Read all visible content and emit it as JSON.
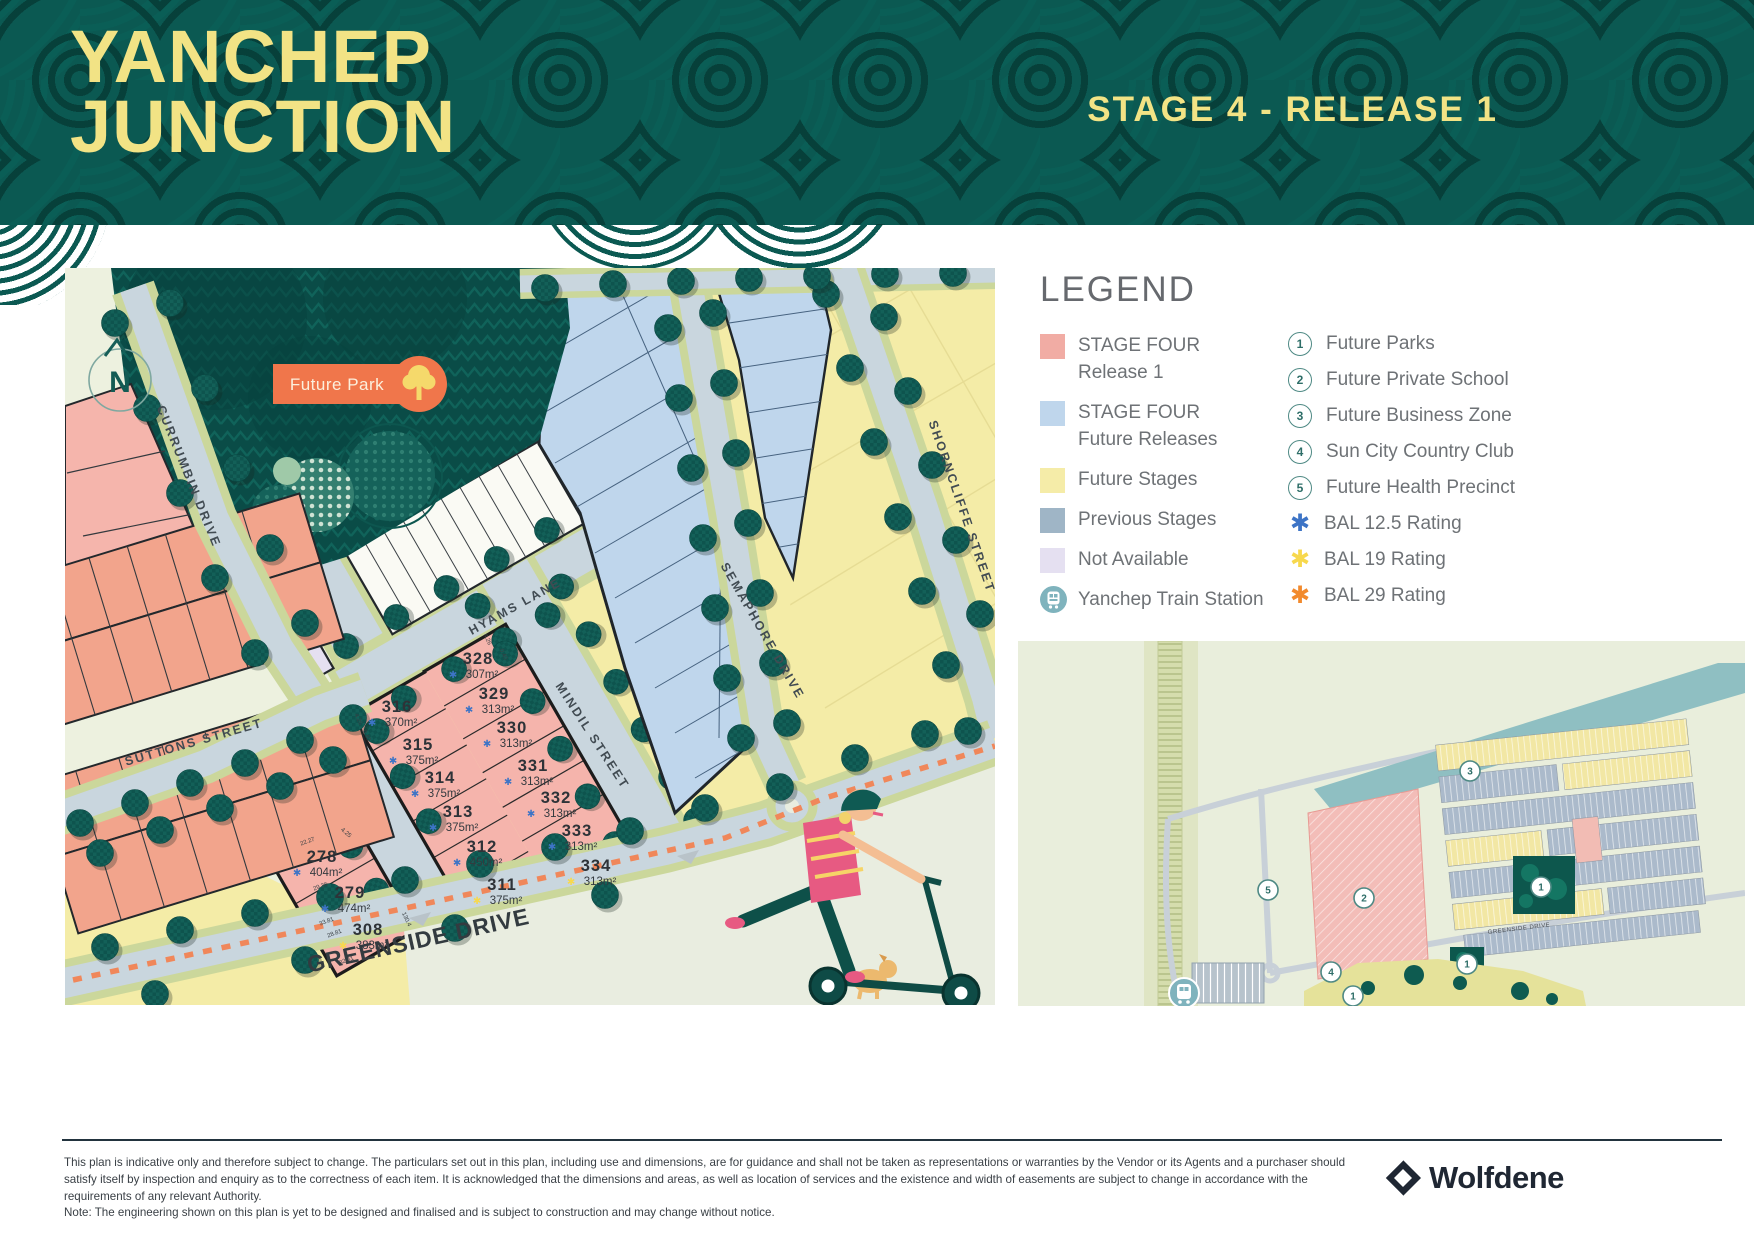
{
  "header": {
    "brand1": "YANCHEP",
    "brand2": "JUNCTION",
    "stage": "STAGE 4 - RELEASE 1"
  },
  "map": {
    "future_park": "Future Park",
    "north": "N",
    "bal_colors": {
      "12.5": "#3D74C6",
      "19": "#F7D84D",
      "29": "#F28A2D"
    },
    "streets": [
      {
        "label": "CURRUMBIN DRIVE",
        "x": 120,
        "y": 210,
        "r": 68
      },
      {
        "label": "SUTTONS STREET",
        "x": 130,
        "y": 478,
        "r": -16
      },
      {
        "label": "HYAMS LANE",
        "x": 452,
        "y": 342,
        "r": -29
      },
      {
        "label": "MINDIL STREET",
        "x": 524,
        "y": 470,
        "r": 57
      },
      {
        "label": "SEMAPHORE DRIVE",
        "x": 694,
        "y": 365,
        "r": 60
      },
      {
        "label": "SHORNCLIFFE STREET",
        "x": 893,
        "y": 240,
        "r": 71
      },
      {
        "label": "GREENSIDE DRIVE",
        "x": 355,
        "y": 680,
        "r": -12.5,
        "big": true
      }
    ],
    "lots": [
      {
        "num": "316",
        "area": "370m²",
        "bal": "12.5",
        "x": 332,
        "y": 444
      },
      {
        "num": "315",
        "area": "375m²",
        "bal": "12.5",
        "x": 353,
        "y": 482
      },
      {
        "num": "314",
        "area": "375m²",
        "bal": "12.5",
        "x": 375,
        "y": 515
      },
      {
        "num": "313",
        "area": "375m²",
        "bal": "12.5",
        "x": 393,
        "y": 549
      },
      {
        "num": "312",
        "area": "450m²",
        "bal": "12.5",
        "x": 417,
        "y": 584
      },
      {
        "num": "311",
        "area": "375m²",
        "bal": "19",
        "x": 437,
        "y": 622
      },
      {
        "num": "328",
        "area": "307m²",
        "bal": "12.5",
        "x": 413,
        "y": 396
      },
      {
        "num": "329",
        "area": "313m²",
        "bal": "12.5",
        "x": 429,
        "y": 431
      },
      {
        "num": "330",
        "area": "313m²",
        "bal": "12.5",
        "x": 447,
        "y": 465
      },
      {
        "num": "331",
        "area": "313m²",
        "bal": "12.5",
        "x": 468,
        "y": 503
      },
      {
        "num": "332",
        "area": "313m²",
        "bal": "12.5",
        "x": 491,
        "y": 535
      },
      {
        "num": "333",
        "area": "313m²",
        "bal": "12.5",
        "x": 512,
        "y": 568
      },
      {
        "num": "334",
        "area": "313m²",
        "bal": "19",
        "x": 531,
        "y": 603
      },
      {
        "num": "278",
        "area": "404m²",
        "bal": "12.5",
        "x": 257,
        "y": 594
      },
      {
        "num": "279",
        "area": "474m²",
        "bal": "12.5",
        "x": 285,
        "y": 630
      },
      {
        "num": "308",
        "area": "383m²",
        "bal": "19",
        "x": 303,
        "y": 667
      }
    ],
    "dims": [
      {
        "t": "22.27",
        "x": 243,
        "y": 575,
        "r": -20
      },
      {
        "t": "29.36",
        "x": 256,
        "y": 620,
        "r": -20
      },
      {
        "t": "33.81",
        "x": 262,
        "y": 655,
        "r": -20
      },
      {
        "t": "28.81",
        "x": 270,
        "y": 667,
        "r": -20
      },
      {
        "t": "32.51",
        "x": 282,
        "y": 694,
        "r": -20
      },
      {
        "t": "4.25",
        "x": 280,
        "y": 566,
        "r": 40
      },
      {
        "t": "4.26",
        "x": 292,
        "y": 452,
        "r": 65
      },
      {
        "t": "0.40",
        "x": 300,
        "y": 468,
        "r": 65
      },
      {
        "t": "4.26",
        "x": 421,
        "y": 372,
        "r": 65
      },
      {
        "t": "0.40",
        "x": 437,
        "y": 387,
        "r": 65
      },
      {
        "t": "130.4",
        "x": 340,
        "y": 652,
        "r": 65
      }
    ]
  },
  "legend": {
    "title": "LEGEND",
    "swatches": [
      {
        "lines": [
          "STAGE FOUR",
          "Release 1"
        ],
        "color": "#F1ACA4"
      },
      {
        "lines": [
          "STAGE FOUR",
          "Future Releases"
        ],
        "color": "#BFD6EC"
      },
      {
        "lines": [
          "Future Stages"
        ],
        "color": "#F5ECA8"
      },
      {
        "lines": [
          "Previous Stages"
        ],
        "color": "#9FB5C6"
      },
      {
        "lines": [
          "Not Available"
        ],
        "color": "#E5E0F1"
      },
      {
        "lines": [
          "Yanchep Train Station"
        ],
        "icon": "train"
      }
    ],
    "markers": [
      {
        "n": "1",
        "label": "Future Parks"
      },
      {
        "n": "2",
        "label": "Future Private School"
      },
      {
        "n": "3",
        "label": "Future Business Zone"
      },
      {
        "n": "4",
        "label": "Sun City Country Club"
      },
      {
        "n": "5",
        "label": "Future Health Precinct"
      },
      {
        "asterisk": "#3D74C6",
        "label": "BAL 12.5 Rating"
      },
      {
        "asterisk": "#F7D84D",
        "label": "BAL 19 Rating"
      },
      {
        "asterisk": "#F28A2D",
        "label": "BAL 29 Rating"
      }
    ]
  },
  "inset": {
    "street_label": "GREENSIDE DRIVE",
    "markers": [
      {
        "n": "5",
        "x": 250,
        "y": 249
      },
      {
        "n": "2",
        "x": 346,
        "y": 257
      },
      {
        "n": "3",
        "x": 452,
        "y": 130
      },
      {
        "n": "1",
        "x": 523,
        "y": 246
      },
      {
        "n": "1",
        "x": 449,
        "y": 323
      },
      {
        "n": "1",
        "x": 335,
        "y": 355
      },
      {
        "n": "4",
        "x": 313,
        "y": 331
      }
    ]
  },
  "footer": {
    "disclaimer": "This plan is indicative only and therefore subject to change. The particulars set out in this plan, including use and dimensions, are for guidance and shall not be taken as representations or warranties by the Vendor or its Agents and a purchaser should satisfy itself by inspection and enquiry as to the correctness of each item. It is acknowledged that the dimensions and areas, as well as location of services and the existence and width of easements are subject to change in accordance with the requirements of any relevant Authority.",
    "note": "Note: The engineering shown on this plan is yet to be designed and finalised and is subject to construction and may change without notice.",
    "brand": "Wolfdene"
  }
}
